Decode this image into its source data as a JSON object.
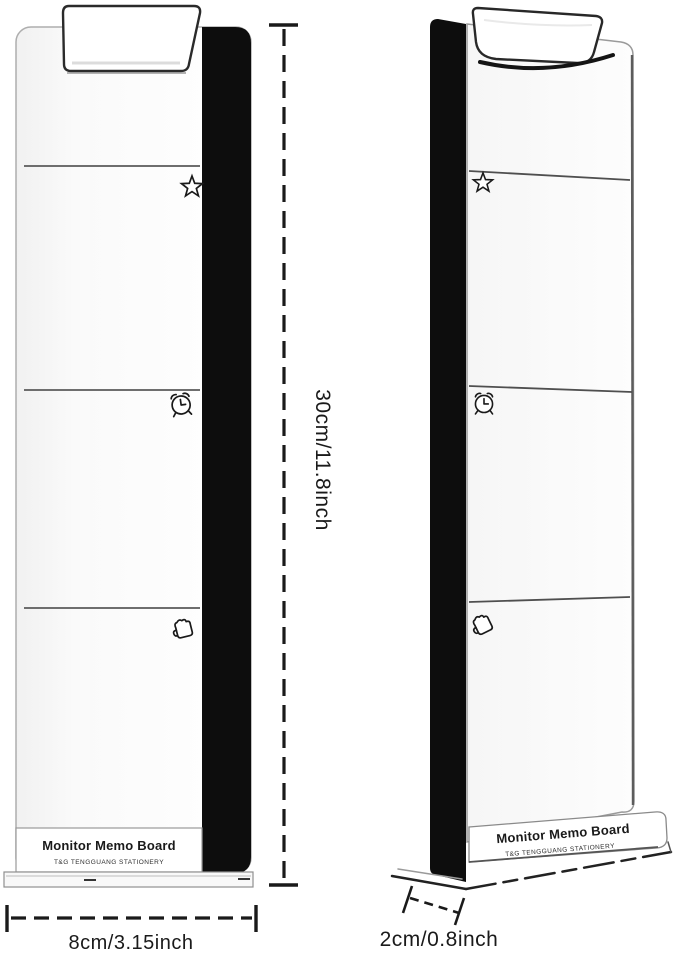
{
  "product": {
    "title": "Monitor Memo Board",
    "subtitle": "T&G TENGGUANG STATIONERY"
  },
  "dimensions": {
    "height": "30cm/11.8inch",
    "width": "8cm/3.15inch",
    "depth": "2cm/0.8inch"
  },
  "icons": {
    "star": "star-icon",
    "clock": "alarm-clock-icon",
    "cup": "cup-icon"
  },
  "colors": {
    "strip_black": "#0d0d0d",
    "divider_gray": "#5a5a5a",
    "dimension_ink": "#1a1a1a",
    "board_edge": "#a8a8a8",
    "background": "#ffffff"
  }
}
